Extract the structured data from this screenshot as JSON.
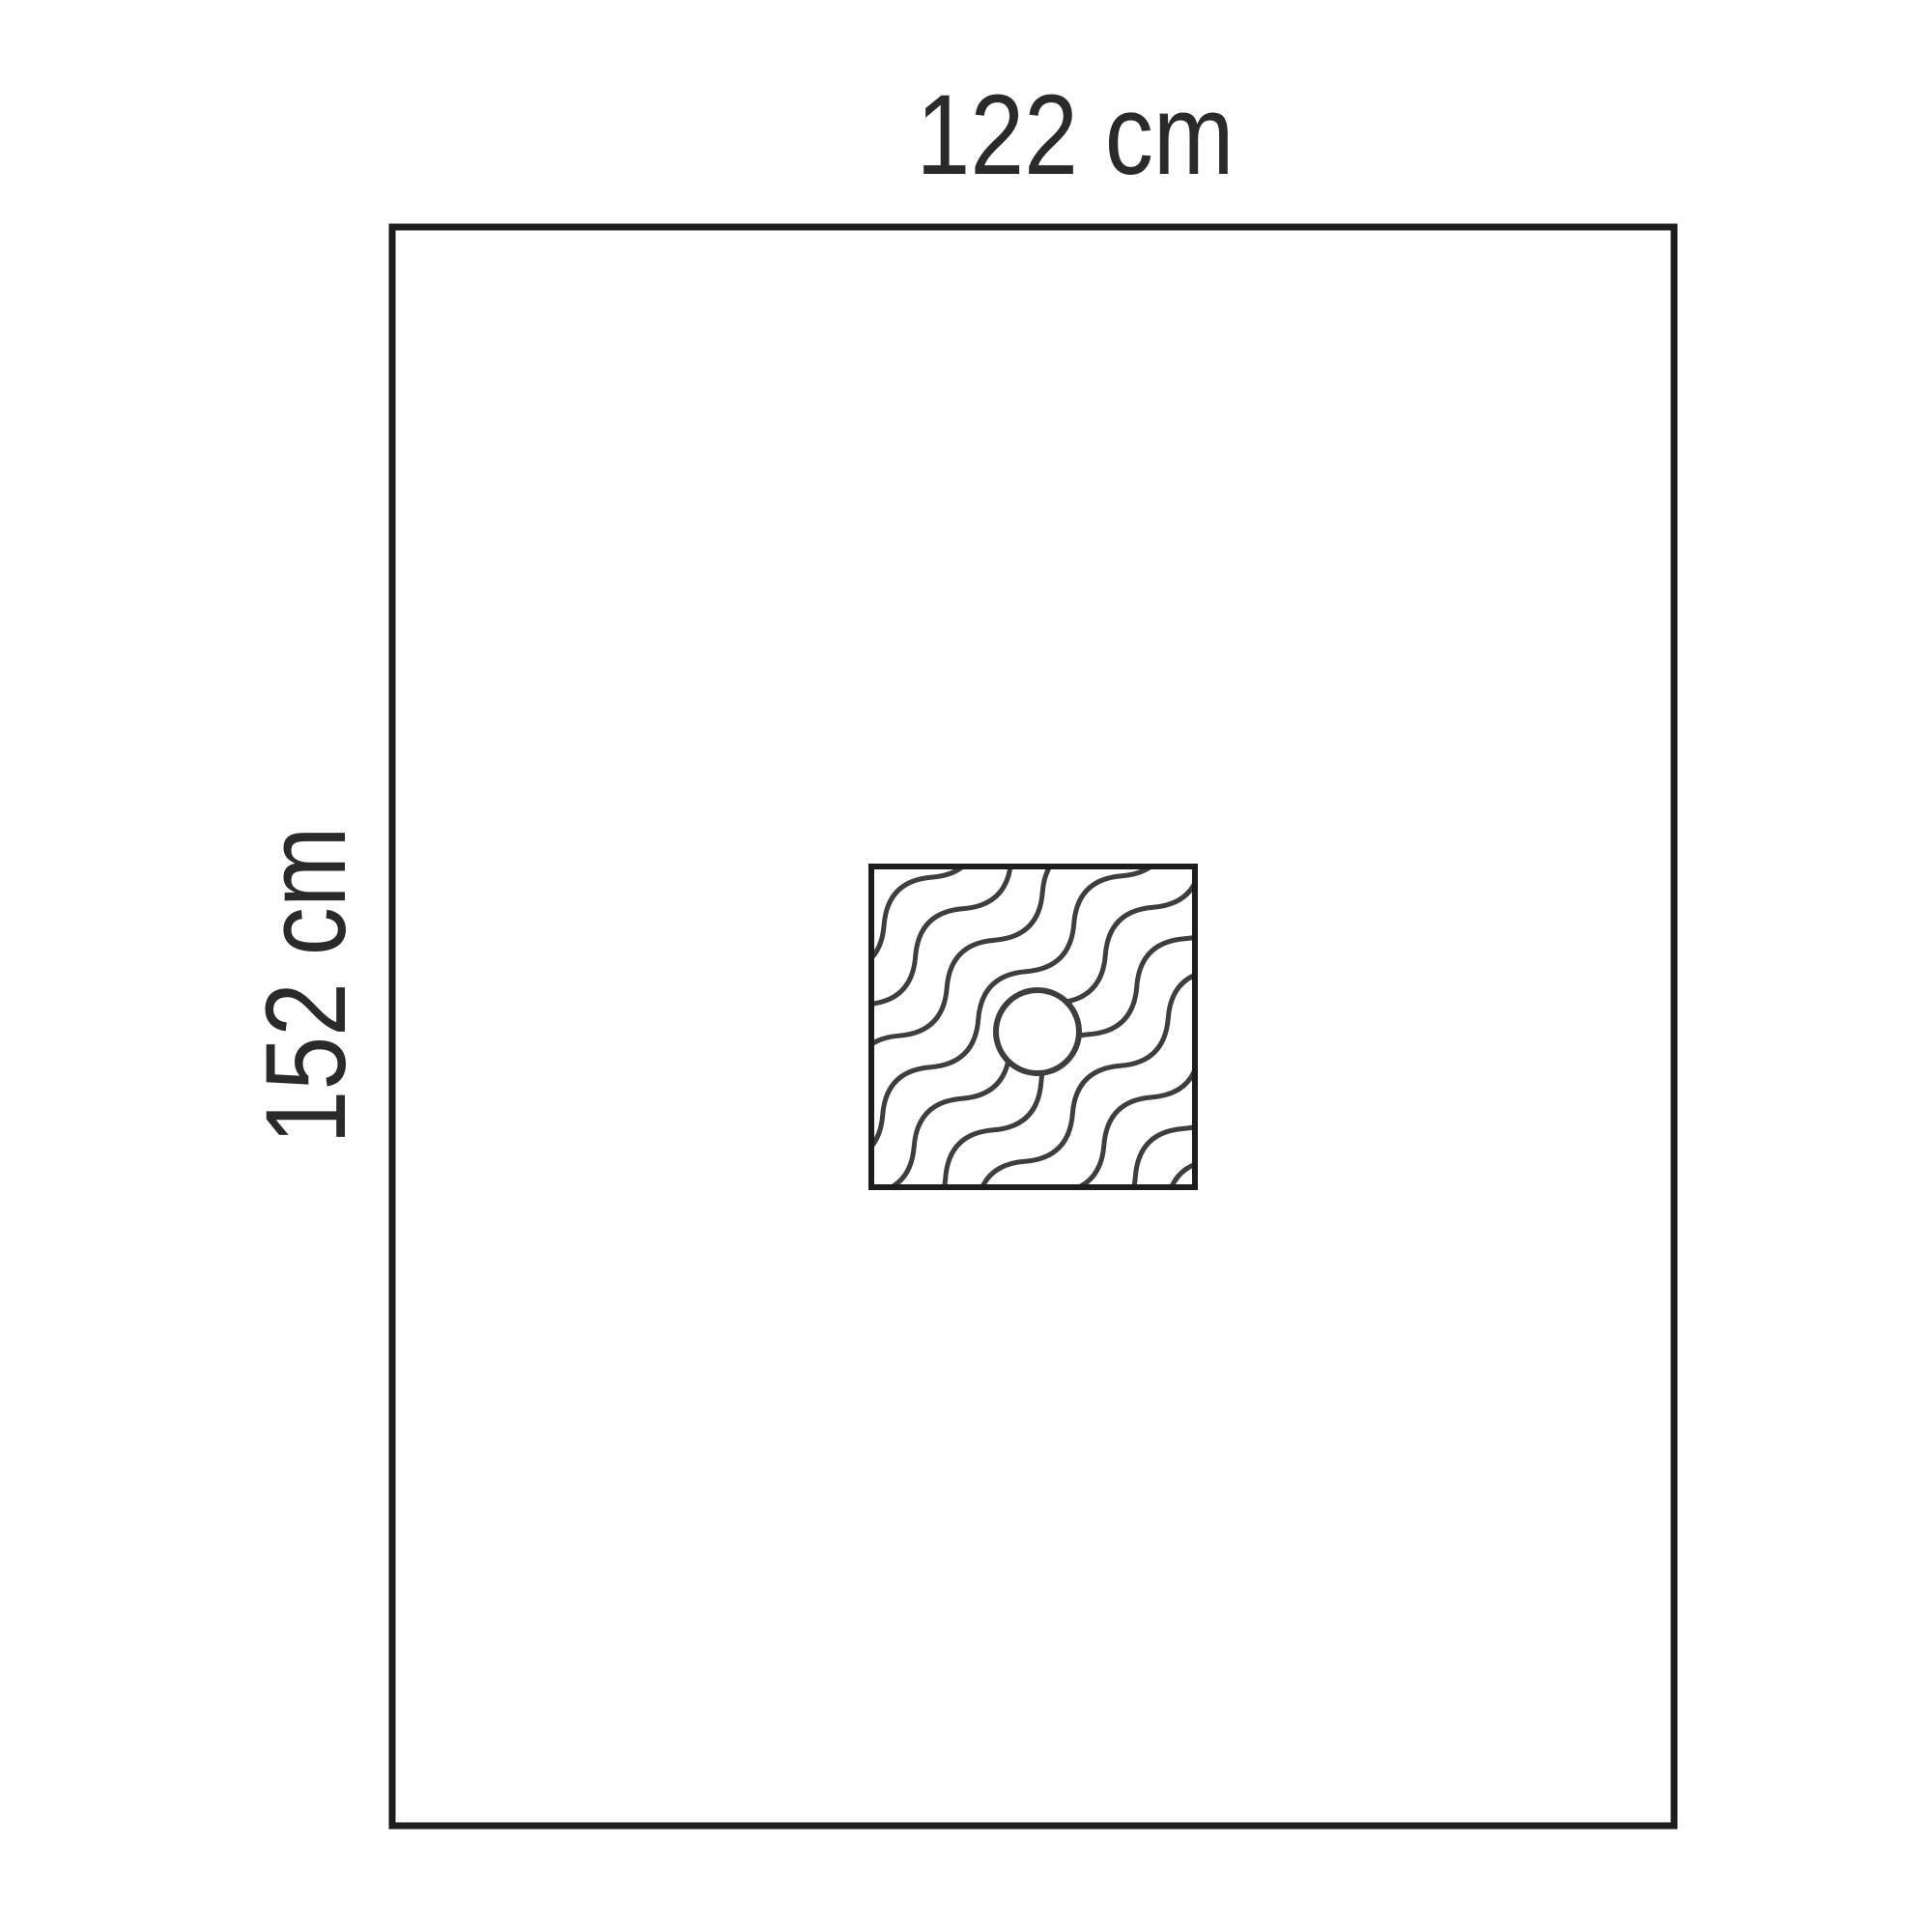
{
  "diagram": {
    "labels": {
      "width": "122 cm",
      "height": "152 cm"
    },
    "colors": {
      "background": "#ffffff",
      "outline": "#1d1d1d",
      "pattern": "#3e3e3e",
      "label": "#2a2a2a"
    }
  }
}
